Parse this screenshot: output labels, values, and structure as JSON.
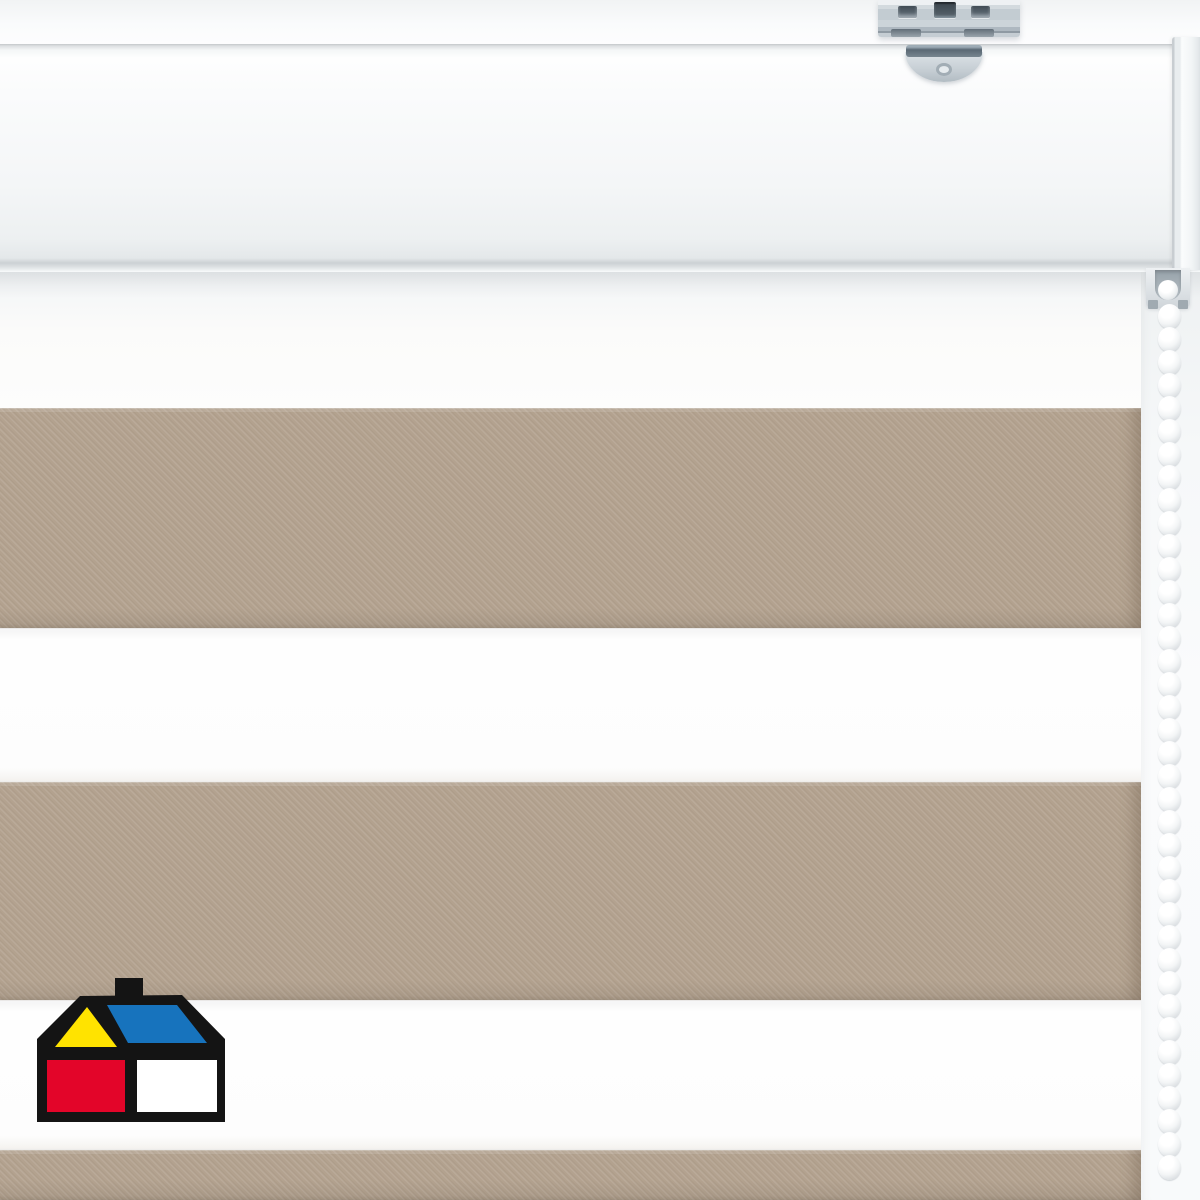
{
  "scene": {
    "type": "product-photo",
    "subject": "Day-night zebra roller blind with beige and white horizontal stripes, white headrail, galvanized ceiling-mount bracket and white bead pull chain",
    "background_color": "#fcfdfe"
  },
  "headrail": {
    "face_color": "#f8fafb",
    "top_edge_color": "#c3c7ca",
    "bottom_edge_color": "#ccd1d4",
    "end_cap_color": "#eef1f3"
  },
  "bracket": {
    "metal_color": "#c6cfd5",
    "slot_color": "#46525c",
    "tab_slot_color": "#66747f"
  },
  "fabric": {
    "right_edge_x": 1141,
    "taupe_color": "#b3a28f",
    "white_color": "#fdfdfd",
    "stripes": [
      {
        "kind": "sheer",
        "top": 270,
        "height": 138
      },
      {
        "kind": "taupe",
        "top": 408,
        "height": 220
      },
      {
        "kind": "white",
        "top": 628,
        "height": 154
      },
      {
        "kind": "taupe",
        "top": 782,
        "height": 218
      },
      {
        "kind": "white",
        "top": 1000,
        "height": 150
      },
      {
        "kind": "taupe",
        "top": 1150,
        "height": 50
      }
    ]
  },
  "chain": {
    "bead_color": "#f3f5f6",
    "bead_count": 38
  },
  "chain_guide": {
    "housing_color": "#e4e9ec",
    "inner_color": "#9aa5ad"
  },
  "logo": {
    "brand": "homecenter-sodimac-house",
    "colors": {
      "outline": "#141414",
      "yellow": "#FFE300",
      "blue": "#1773BD",
      "red": "#E30529",
      "white": "#FFFFFF"
    }
  }
}
